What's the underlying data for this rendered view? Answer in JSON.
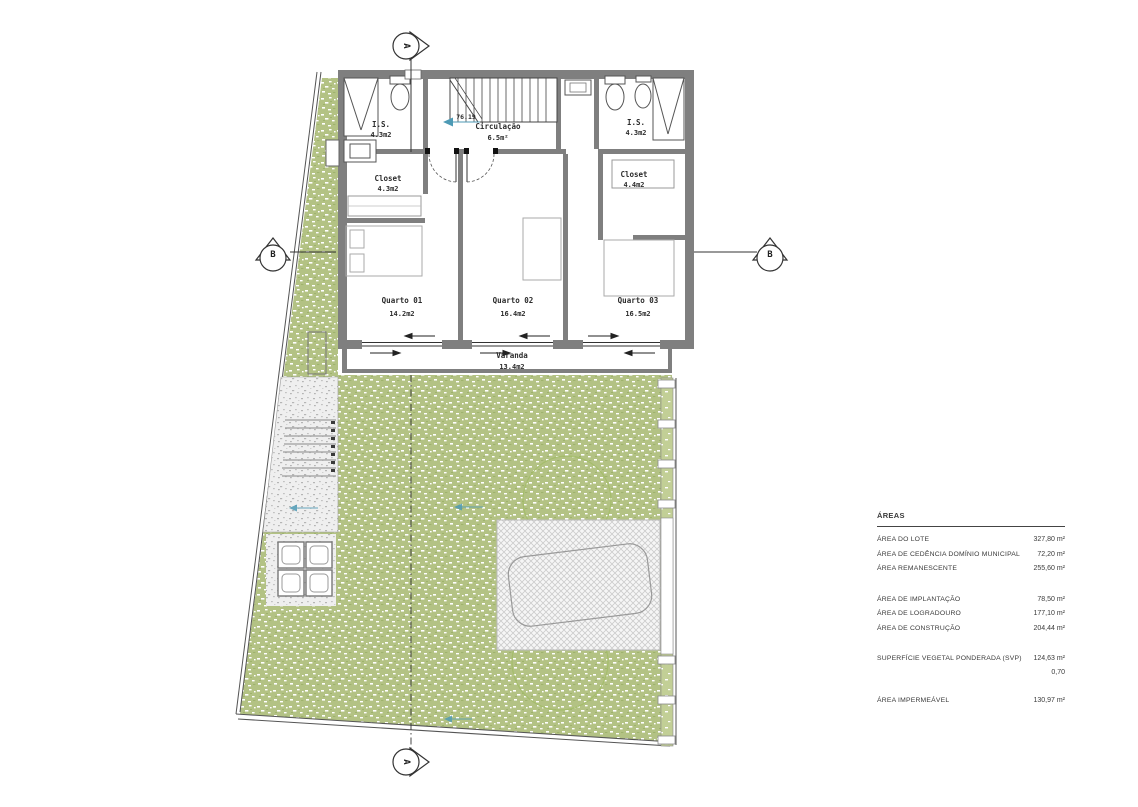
{
  "plan": {
    "rooms": {
      "bath_left": {
        "label": "I.S.",
        "area": "4.3m2"
      },
      "circulation": {
        "label": "Circulação",
        "area": "6.5m²"
      },
      "bath_right": {
        "label": "I.S.",
        "area": "4.3m2"
      },
      "closet_left": {
        "label": "Closet",
        "area": "4.3m2"
      },
      "closet_right": {
        "label": "Closet",
        "area": "4.4m2"
      },
      "bedroom1": {
        "label": "Quarto 01",
        "area": "14.2m2"
      },
      "bedroom2": {
        "label": "Quarto 02",
        "area": "16.4m2"
      },
      "bedroom3": {
        "label": "Quarto 03",
        "area": "16.5m2"
      },
      "balcony": {
        "label": "Varanda",
        "area": "13.4m2"
      }
    },
    "level_marker": "76.19",
    "section_labels": {
      "a": "A",
      "b": "B"
    }
  },
  "areas_table": {
    "title": "ÁREAS",
    "rows": [
      {
        "label": "ÁREA DO LOTE",
        "value": "327,80 m²"
      },
      {
        "label": "ÁREA DE CEDÊNCIA DOMÍNIO MUNICIPAL",
        "value": "72,20 m²"
      },
      {
        "label": "ÁREA REMANESCENTE",
        "value": "255,60 m²"
      },
      {
        "label": "ÁREA DE IMPLANTAÇÃO",
        "value": "78,50 m²"
      },
      {
        "label": "ÁREA DE LOGRADOURO",
        "value": "177,10 m²"
      },
      {
        "label": "ÁREA DE CONSTRUÇÃO",
        "value": "204,44 m²"
      },
      {
        "label": "SUPERFÍCIE VEGETAL PONDERADA (SVP)",
        "value": "124,63 m²",
        "value2": "0,70"
      },
      {
        "label": "ÁREA IMPERMEÁVEL",
        "value": "130,97 m²"
      }
    ]
  },
  "colors": {
    "wall": "#7f7f7f",
    "grass": "#b3c284",
    "marker_blue": "#4d9ab5",
    "paving_hatch": "#cfcfcf"
  }
}
